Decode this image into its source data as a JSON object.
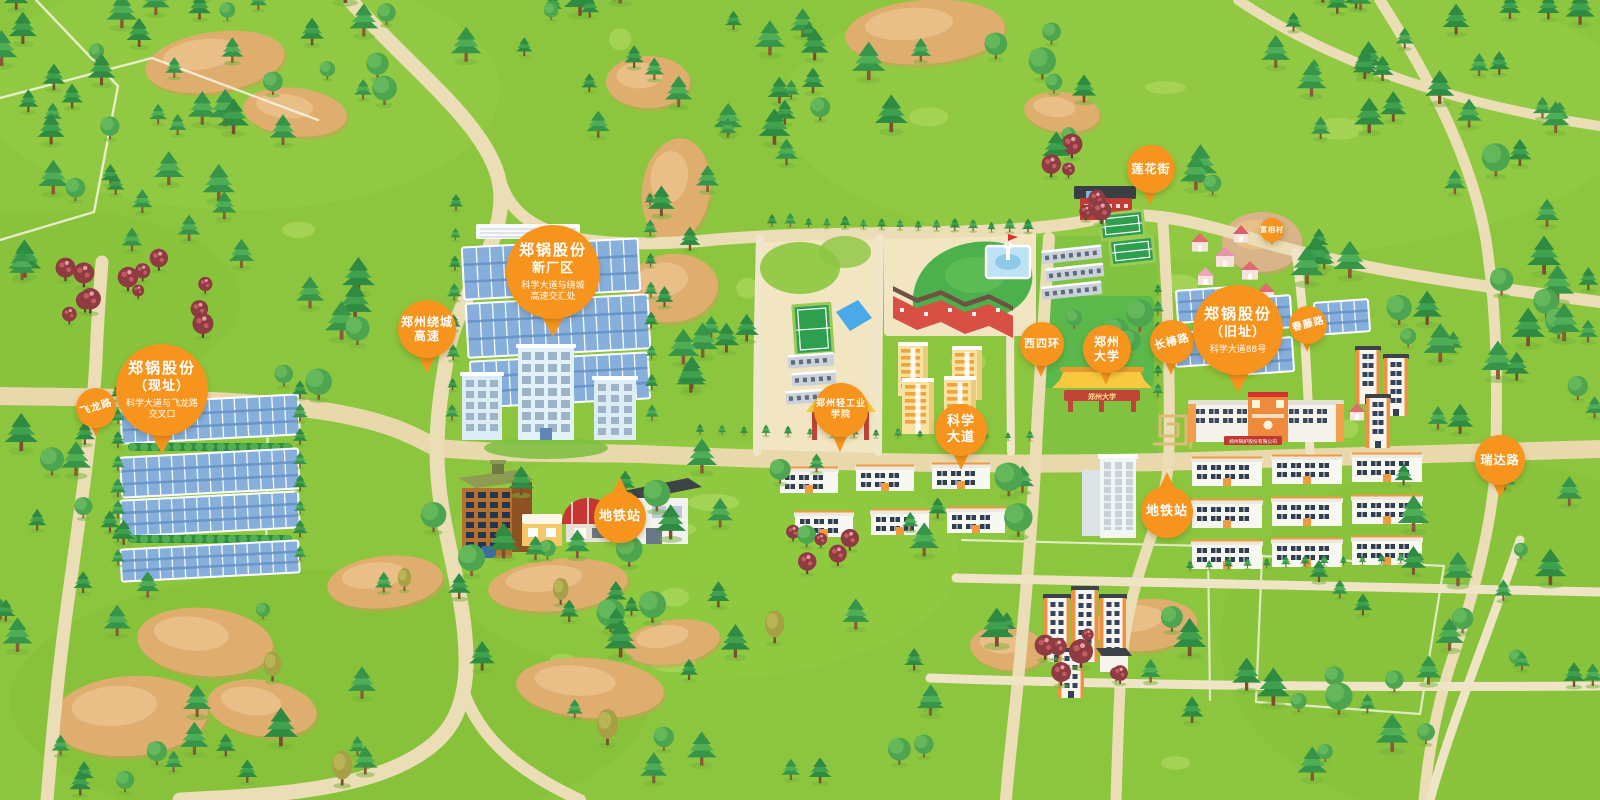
{
  "map": {
    "colors": {
      "label_orange": "#F7941E",
      "grass": "#8CC63E",
      "road_tan": "#EBDDB5",
      "panel_blue": "#86AFDC",
      "pine_green": "#2E8B41",
      "dirt_tan": "#DFAE6E"
    },
    "markers": [
      {
        "id": "feilong-road",
        "type": "pill",
        "lines": [
          "飞龙路"
        ],
        "x": 96,
        "y": 408,
        "size": 40,
        "font": 10,
        "rotate": -18,
        "tail": "down"
      },
      {
        "id": "zhengguo-current-site",
        "type": "balloon",
        "title": [
          "郑锅股份",
          "（现址）"
        ],
        "subtitle": [
          "科学大道与飞龙路",
          "交叉口"
        ],
        "x": 162,
        "y": 390,
        "size": 92,
        "tail": "down"
      },
      {
        "id": "raocheng-expressway",
        "type": "pill",
        "lines": [
          "郑州绕城",
          "高速"
        ],
        "x": 427,
        "y": 329,
        "size": 58,
        "font": 12,
        "tail": "down"
      },
      {
        "id": "zhengguo-new-plant",
        "type": "balloon",
        "title": [
          "郑锅股份",
          "新厂区"
        ],
        "subtitle": [
          "科学大道与绕城",
          "高速交汇处"
        ],
        "x": 553,
        "y": 272,
        "size": 94,
        "tail": "down"
      },
      {
        "id": "metro-station-west",
        "type": "pill",
        "lines": [
          "地铁站"
        ],
        "x": 620,
        "y": 517,
        "size": 52,
        "font": 13,
        "tail": "up"
      },
      {
        "id": "qinggong-college",
        "type": "pill",
        "lines": [
          "郑州轻工业",
          "学院"
        ],
        "x": 841,
        "y": 410,
        "size": 54,
        "font": 9,
        "tail": "down"
      },
      {
        "id": "kexue-avenue",
        "type": "pill",
        "lines": [
          "科学",
          "大道"
        ],
        "x": 961,
        "y": 430,
        "size": 52,
        "font": 13,
        "tail": "down"
      },
      {
        "id": "xisihuan-road",
        "type": "pill",
        "lines": [
          "西四环"
        ],
        "x": 1042,
        "y": 344,
        "size": 44,
        "font": 11,
        "tail": "down"
      },
      {
        "id": "zhengzhou-university",
        "type": "pill",
        "lines": [
          "郑州",
          "大学"
        ],
        "x": 1107,
        "y": 349,
        "size": 48,
        "font": 12,
        "tail": "down"
      },
      {
        "id": "changchun-road",
        "type": "pill",
        "lines": [
          "长椿路"
        ],
        "x": 1172,
        "y": 342,
        "size": 44,
        "font": 11,
        "rotate": -14,
        "tail": "down"
      },
      {
        "id": "lianhua-street",
        "type": "pill",
        "lines": [
          "莲花街"
        ],
        "x": 1151,
        "y": 169,
        "size": 48,
        "font": 12,
        "tail": "down"
      },
      {
        "id": "zhengguo-old-site",
        "type": "balloon",
        "title": [
          "郑锅股份",
          "（旧址）"
        ],
        "subtitle": [
          "科学大道88号"
        ],
        "x": 1238,
        "y": 330,
        "size": 90,
        "tail": "down"
      },
      {
        "id": "chunteng-road",
        "type": "pill",
        "lines": [
          "春藤路"
        ],
        "x": 1308,
        "y": 325,
        "size": 38,
        "font": 10,
        "rotate": -14,
        "tail": "down"
      },
      {
        "id": "metro-station-east",
        "type": "pill",
        "lines": [
          "地铁站"
        ],
        "x": 1167,
        "y": 512,
        "size": 52,
        "font": 13,
        "tail": "up"
      },
      {
        "id": "ruida-road",
        "type": "pill",
        "lines": [
          "瑞达路"
        ],
        "x": 1500,
        "y": 460,
        "size": 50,
        "font": 12,
        "tail": "down"
      },
      {
        "id": "village-marker",
        "type": "pill",
        "lines": [
          "富相村"
        ],
        "x": 1272,
        "y": 230,
        "size": 24,
        "font": 7,
        "tail": "down"
      }
    ],
    "signs": {
      "zhengzhou_university_gate": "郑州大学",
      "qinggong_gate": "郑州轻工业学院",
      "old_site_banner": "郑州锅炉股份有限公司"
    }
  }
}
